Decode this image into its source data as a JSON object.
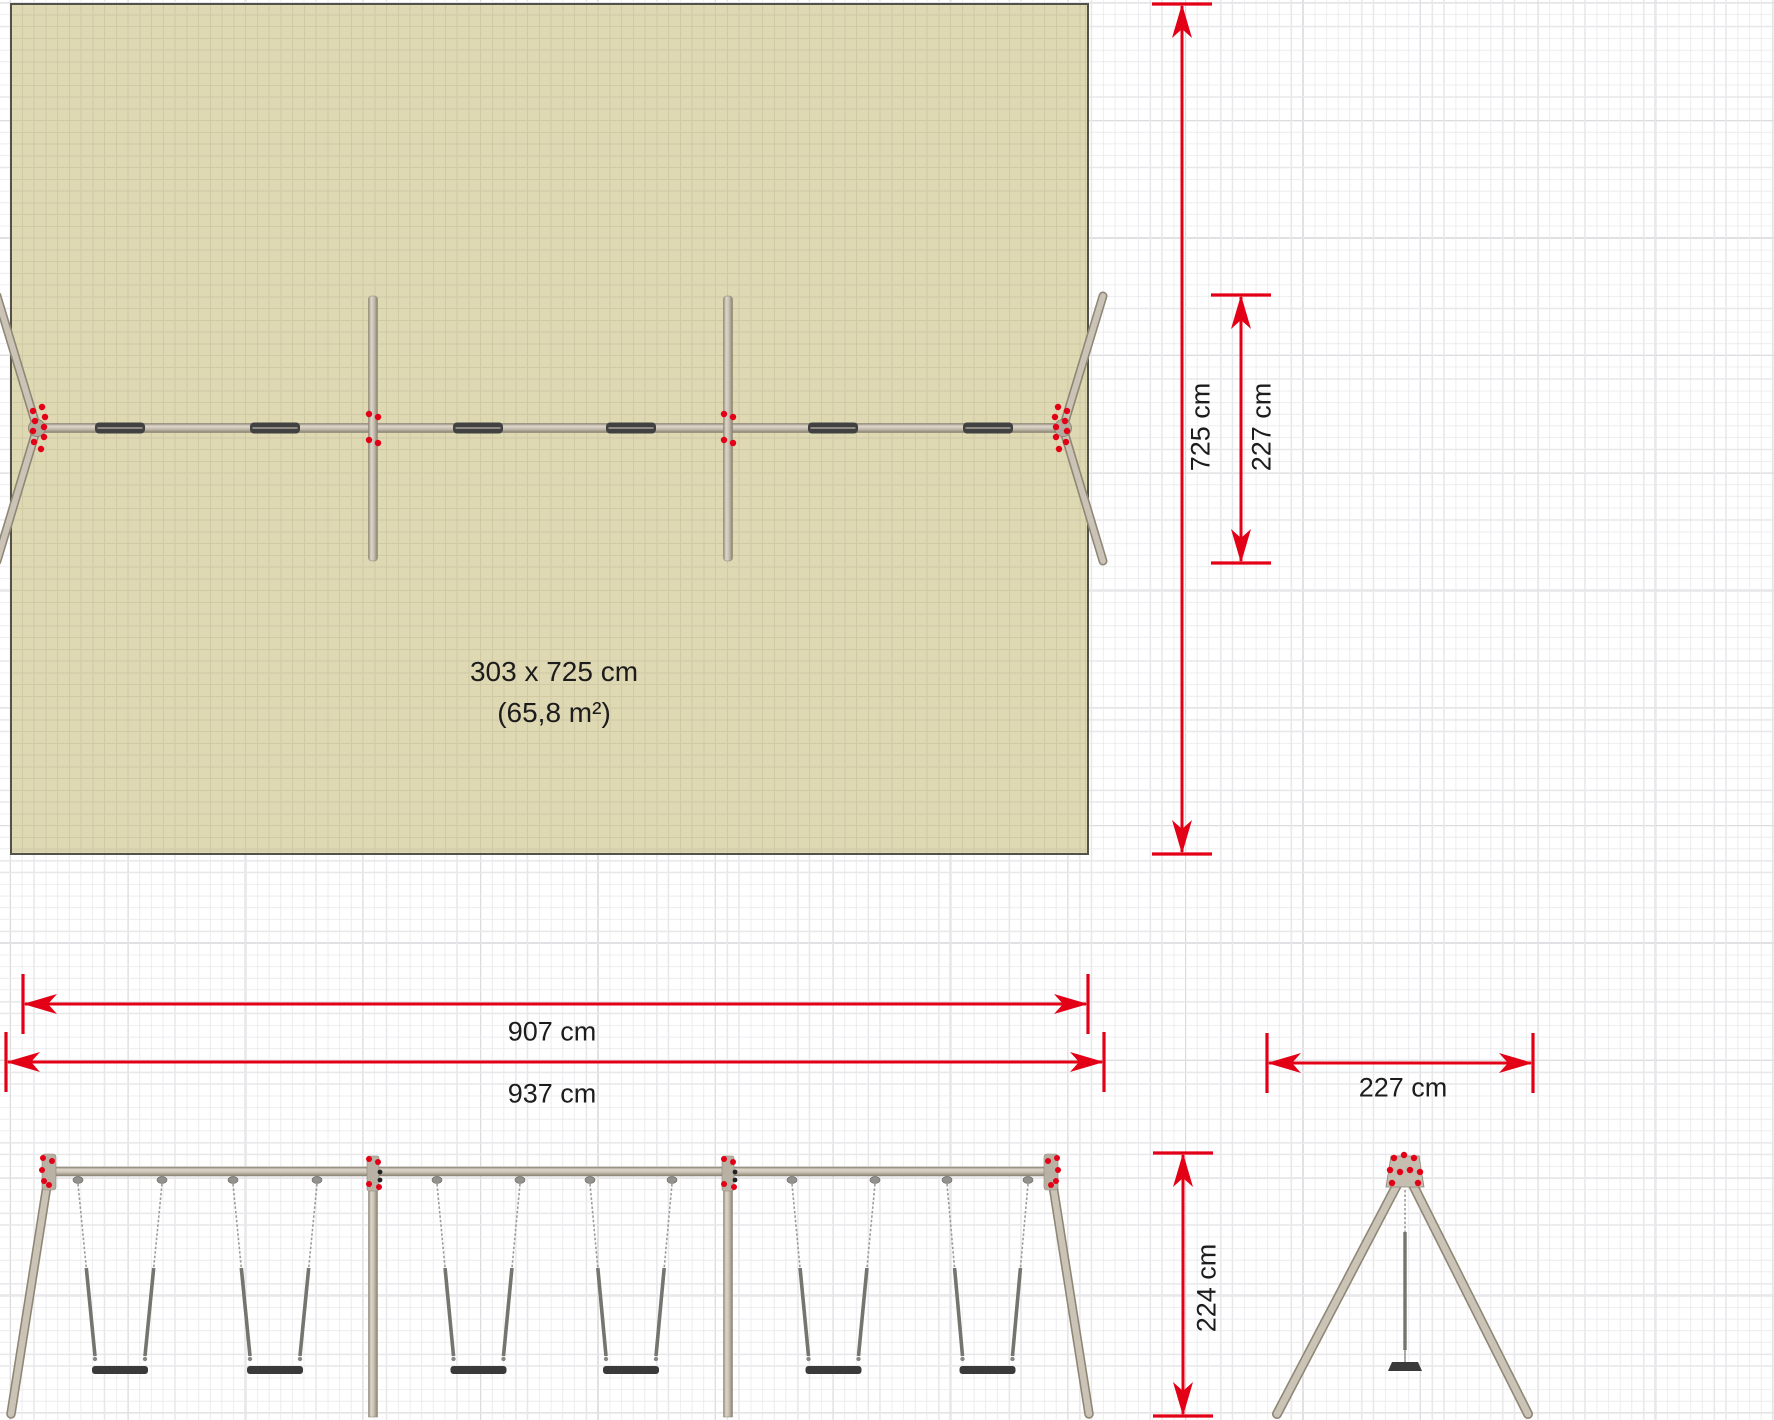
{
  "drawing": {
    "type": "playground-swing-set-technical-drawing",
    "views": [
      "plan-top-view",
      "front-elevation",
      "side-elevation"
    ],
    "area_label": {
      "line1": "303 x 725 cm",
      "line2": "(65,8 m²)"
    },
    "labels": [
      {
        "text": "303 x 725 cm",
        "x": 554,
        "y": 672,
        "rot": 0,
        "size": 28
      },
      {
        "text": "(65,8 m²)",
        "x": 554,
        "y": 713,
        "rot": 0,
        "size": 28
      },
      {
        "text": "725 cm",
        "x": 1201,
        "y": 427,
        "rot": -90,
        "size": 27
      },
      {
        "text": "227 cm",
        "x": 1262,
        "y": 427,
        "rot": -90,
        "size": 27
      },
      {
        "text": "907 cm",
        "x": 552,
        "y": 1032,
        "rot": 0,
        "size": 27
      },
      {
        "text": "937 cm",
        "x": 552,
        "y": 1094,
        "rot": 0,
        "size": 27
      },
      {
        "text": "227 cm",
        "x": 1403,
        "y": 1088,
        "rot": 0,
        "size": 27
      },
      {
        "text": "224 cm",
        "x": 1207,
        "y": 1288,
        "rot": -90,
        "size": 27
      }
    ],
    "dimensions": [
      {
        "name": "plan-area-length",
        "orientation": "v",
        "x": 1182,
        "from": 4,
        "to": 854,
        "label": "725 cm"
      },
      {
        "name": "plan-leg-spread",
        "orientation": "v",
        "x": 1241,
        "from": 295,
        "to": 563,
        "label": "227 cm"
      },
      {
        "name": "front-beam-span",
        "orientation": "h",
        "y": 1004,
        "from": 23,
        "to": 1088,
        "label": "907 cm"
      },
      {
        "name": "front-total-width",
        "orientation": "h",
        "y": 1062,
        "from": 6,
        "to": 1104,
        "label": "937 cm"
      },
      {
        "name": "side-leg-spread",
        "orientation": "h",
        "y": 1063,
        "from": 1267,
        "to": 1533,
        "label": "227 cm"
      },
      {
        "name": "side-height",
        "orientation": "v",
        "x": 1183,
        "from": 1153,
        "to": 1416,
        "label": "224 cm"
      }
    ],
    "colors": {
      "safety_area_fill": "#ded8b3",
      "safety_area_border": "#52524b",
      "grid_minor": "#e8e8eb",
      "grid_major": "#9b9ba1",
      "grid_minor_on_area": "#cfc9a4",
      "grid_major_on_area": "#82816e",
      "dimension_red": "#e30016",
      "metal_dark": "#8f8776",
      "metal_light": "#cbc4b6",
      "metal_fill": "#bcb5a7",
      "seat_dark": "#3a3a3a",
      "chain_gray": "#9e9c99",
      "rod_gray": "#76746e",
      "dot_black": "#222222",
      "label_text": "#1c1c1c"
    },
    "geom": {
      "plan": {
        "beam": {
          "x1": 37,
          "x2": 1063,
          "y": 428,
          "w": 9
        },
        "hubs": [
          37,
          1063
        ],
        "legs": [
          [
            37,
            428,
            -3,
            296
          ],
          [
            37,
            428,
            -3,
            561
          ],
          [
            1063,
            428,
            1103,
            296
          ],
          [
            1063,
            428,
            1103,
            561
          ]
        ],
        "posts": {
          "xs": [
            373,
            728
          ],
          "y1": 296,
          "y2": 561,
          "w": 9
        },
        "seats": {
          "centers": [
            120,
            275,
            478,
            631,
            833,
            988
          ],
          "w": 50,
          "h": 11
        },
        "hub_dots": [
          [
            -5,
            -21
          ],
          [
            4,
            -17
          ],
          [
            -8,
            -11
          ],
          [
            2,
            -7
          ],
          [
            -7,
            -1
          ],
          [
            4,
            3
          ],
          [
            -7,
            9
          ],
          [
            3,
            14
          ],
          [
            -4,
            21
          ]
        ],
        "post_dots": [
          [
            -4,
            -14
          ],
          [
            5,
            -11
          ],
          [
            -4,
            12
          ],
          [
            5,
            15
          ]
        ]
      },
      "front": {
        "beam": {
          "x1": 43,
          "x2": 1057,
          "y": 1171.5,
          "w": 9
        },
        "legs": [
          [
            51,
            1160,
            11,
            1414
          ],
          [
            1049,
            1160,
            1089,
            1414
          ]
        ],
        "posts": {
          "xs": [
            373,
            728
          ],
          "y1": 1158,
          "y2": 1417,
          "w": 9
        },
        "corner_fittings": [
          49,
          1051
        ],
        "corner_dots": [
          [
            -6,
            -14
          ],
          [
            3,
            -11
          ],
          [
            -7,
            -2
          ],
          [
            -5,
            9
          ],
          [
            0,
            13
          ]
        ],
        "post_red_dots": [
          [
            -4,
            -13
          ],
          [
            5,
            -10
          ],
          [
            -4,
            12
          ],
          [
            6,
            15
          ]
        ],
        "post_black_dots": [
          [
            7,
            0
          ],
          [
            7,
            8
          ]
        ],
        "hanger_pairs": [
          [
            78,
            162
          ],
          [
            233,
            317
          ],
          [
            437,
            520
          ],
          [
            590,
            672
          ],
          [
            792,
            875
          ],
          [
            947,
            1028
          ]
        ],
        "chain": {
          "top_y": 1184,
          "mid_y": 1268,
          "bot_y": 1356,
          "bot_half": 25
        },
        "seat": {
          "y": 1366,
          "h": 8,
          "half_w": 28
        }
      },
      "side": {
        "apex": {
          "cx": 1405,
          "plate": [
            [
              1391,
              1156
            ],
            [
              1419,
              1156
            ],
            [
              1424,
              1187
            ],
            [
              1386,
              1187
            ]
          ]
        },
        "apex_dots": [
          [
            -11,
            -12
          ],
          [
            -1,
            -15
          ],
          [
            9,
            -12
          ],
          [
            -15,
            0
          ],
          [
            -5,
            2
          ],
          [
            5,
            0
          ],
          [
            15,
            2
          ],
          [
            -13,
            13
          ],
          [
            13,
            13
          ]
        ],
        "apex_dot_center": [
          1405,
          1170
        ],
        "legs": [
          [
            1398,
            1183,
            1277,
            1414
          ],
          [
            1412,
            1183,
            1528,
            1414
          ]
        ],
        "chain": {
          "x": 1405,
          "thin_y1": 1190,
          "thin_y2": 1232,
          "rod_y2": 1350
        },
        "seat_poly": [
          [
            1392,
            1362
          ],
          [
            1418,
            1362
          ],
          [
            1422,
            1371
          ],
          [
            1388,
            1371
          ]
        ]
      },
      "tick_half": 30,
      "arrow": {
        "len": 34,
        "half_w": 10
      }
    }
  }
}
